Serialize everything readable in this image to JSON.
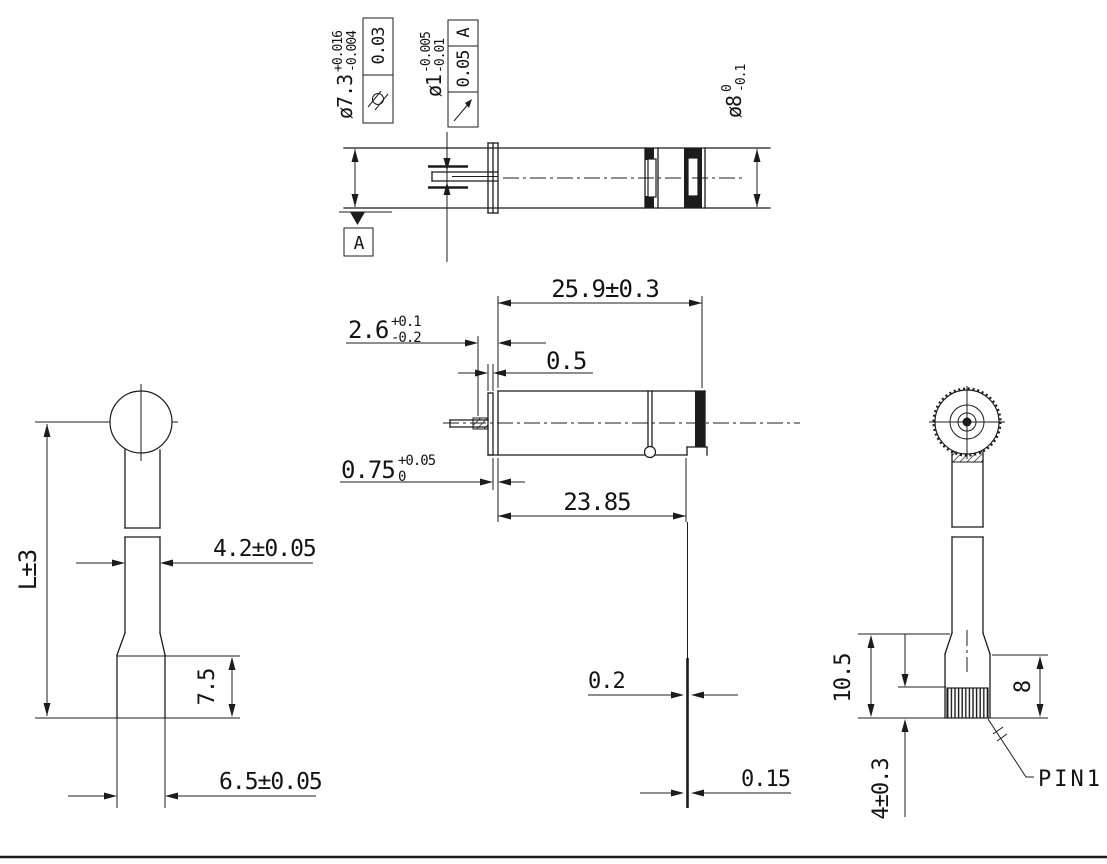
{
  "top": {
    "body_dia": {
      "main": "ø7.3",
      "sup": "+0.016",
      "sub": "-0.004"
    },
    "fcf_cyl": {
      "icon": "cylindricity-icon",
      "value": "0.03"
    },
    "shaft_dia": {
      "main": "ø1",
      "sup": "-0.005",
      "sub": "-0.01"
    },
    "fcf_runout": {
      "icon": "circular-runout-icon",
      "value": "0.05",
      "datum": "A"
    },
    "end_dia": {
      "main": "ø8",
      "sup": "0",
      "sub": "-0.1"
    },
    "datum_label": "A"
  },
  "main": {
    "total_length": "25.9±0.3",
    "shaft_ext": {
      "main": "2.6",
      "sup": "+0.1",
      "sub": "-0.2"
    },
    "flange_gap": "0.5",
    "washer": {
      "main": "0.75",
      "sup": "+0.05",
      "sub": "0"
    },
    "case_length": "23.85",
    "terminal_a": "0.2",
    "terminal_b": "0.15"
  },
  "front": {
    "overall": "L±3",
    "stem_width": "4.2±0.05",
    "base_height": "7.5",
    "base_width": "6.5±0.05"
  },
  "end": {
    "bracket_height": "10.5",
    "pin_zone": "8",
    "pin_length": "4±0.3",
    "pin_label": "PIN1"
  },
  "colors": {
    "ink": "#1c1c1c",
    "paper": "#ffffff"
  }
}
